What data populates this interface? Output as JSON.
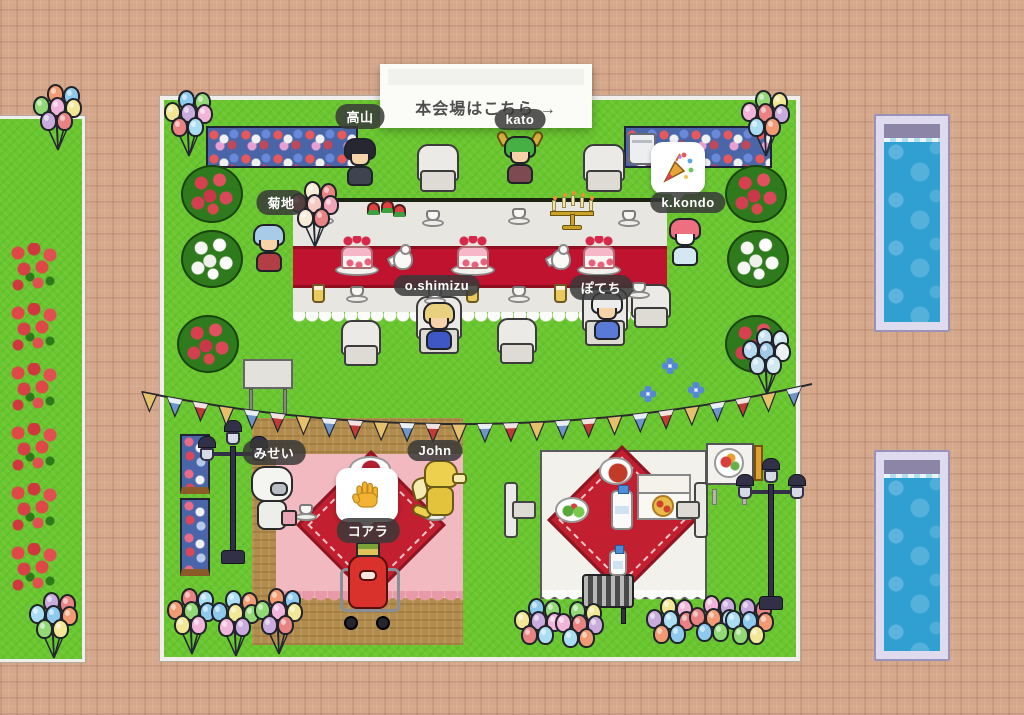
{
  "scene": {
    "sign_text": "本会場はこちら →"
  },
  "players": {
    "takayama": {
      "name": "高山"
    },
    "kato": {
      "name": "kato"
    },
    "kikuchi": {
      "name": "菊地"
    },
    "kkondo": {
      "name": "k.kondo",
      "reaction": "party-popper"
    },
    "oshimizu": {
      "name": "o.shimizu"
    },
    "potechi": {
      "name": "ぽてち"
    },
    "misei": {
      "name": "みせい"
    },
    "john": {
      "name": "John"
    },
    "koala": {
      "name": "コアラ",
      "reaction": "raised-hand"
    }
  },
  "colors": {
    "brick": "#d5a88c",
    "grass": "#69c62e",
    "dirt": "#b18c4e",
    "border_white": "#f0efec",
    "pool_frame": "#dfdbee",
    "pool_water": "#309fd2",
    "table_top": "#e8e6e1",
    "table_runner": "#bf1330",
    "blanket_pink": "#f3b9c1",
    "blanket_red": "#c21f30",
    "nametag_bg": "rgba(56,56,56,0.85)",
    "nametag_text": "#ffffff",
    "balloons_pastel": [
      "#f29a72",
      "#8ec9ee",
      "#93d877",
      "#f2e795",
      "#f0b5d9",
      "#c9abdd",
      "#e98383",
      "#aadcf2"
    ],
    "balloons_warm": [
      "#ea6f60",
      "#f2a4ba",
      "#f6c9c2",
      "#f8ecd9",
      "#e98383"
    ],
    "balloons_cool": [
      "#d2e9f2",
      "#b9d9ee",
      "#eaf2f6",
      "#a2c9e6",
      "#c6e2f0"
    ],
    "bunting": [
      "#e6c16d",
      "#6f94ca",
      "#c23a38"
    ]
  }
}
